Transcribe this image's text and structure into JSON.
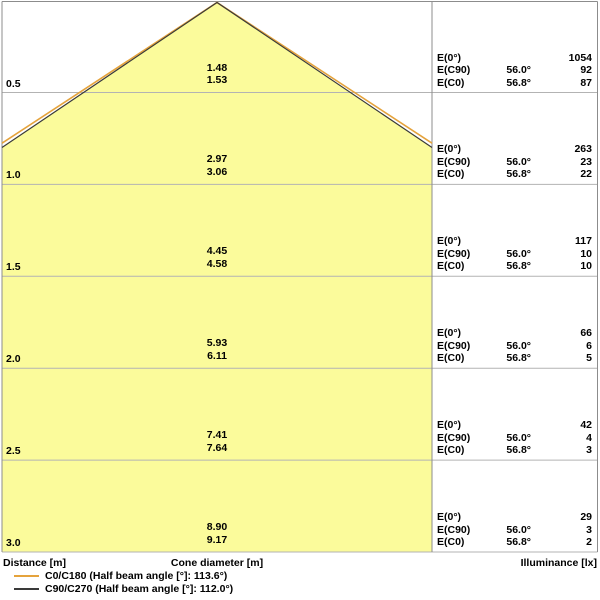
{
  "colors": {
    "cone_fill": "#FBFB9B",
    "c0_line": "#E5A33C",
    "c90_line": "#3A3A39",
    "grid_line": "#B3B3B3",
    "frame_line": "#8C8C8C",
    "text": "#000000"
  },
  "chart_data": {
    "type": "area",
    "subtype": "photometric-beam-cone-diagram",
    "orientation": "apex-top",
    "half_beam_angles": {
      "c0_c180_deg": 113.6,
      "c90_c270_deg": 112.0
    },
    "column_labels": {
      "e0": "E(0°)",
      "ec90": "E(C90)",
      "ec0": "E(C0)"
    },
    "angles": {
      "ec90": "56.0°",
      "ec0": "56.8°"
    },
    "rows": [
      {
        "distance": "0.5",
        "cone_diameter_c90": "1.48",
        "cone_diameter_c0": "1.53",
        "e0": "1054",
        "ec90": "92",
        "ec0": "87"
      },
      {
        "distance": "1.0",
        "cone_diameter_c90": "2.97",
        "cone_diameter_c0": "3.06",
        "e0": "263",
        "ec90": "23",
        "ec0": "22"
      },
      {
        "distance": "1.5",
        "cone_diameter_c90": "4.45",
        "cone_diameter_c0": "4.58",
        "e0": "117",
        "ec90": "10",
        "ec0": "10"
      },
      {
        "distance": "2.0",
        "cone_diameter_c90": "5.93",
        "cone_diameter_c0": "6.11",
        "e0": "66",
        "ec90": "6",
        "ec0": "5"
      },
      {
        "distance": "2.5",
        "cone_diameter_c90": "7.41",
        "cone_diameter_c0": "7.64",
        "e0": "42",
        "ec90": "4",
        "ec0": "3"
      },
      {
        "distance": "3.0",
        "cone_diameter_c90": "8.90",
        "cone_diameter_c0": "9.17",
        "e0": "29",
        "ec90": "3",
        "ec0": "2"
      }
    ],
    "footer": {
      "distance": "Distance [m]",
      "cone": "Cone diameter [m]",
      "illuminance": "Illuminance [lx]"
    },
    "legend": [
      {
        "label": "C0/C180 (Half beam angle [°]: 113.6°)",
        "color": "#E5A33C"
      },
      {
        "label": "C90/C270 (Half beam angle [°]: 112.0°)",
        "color": "#3A3A39"
      }
    ]
  }
}
